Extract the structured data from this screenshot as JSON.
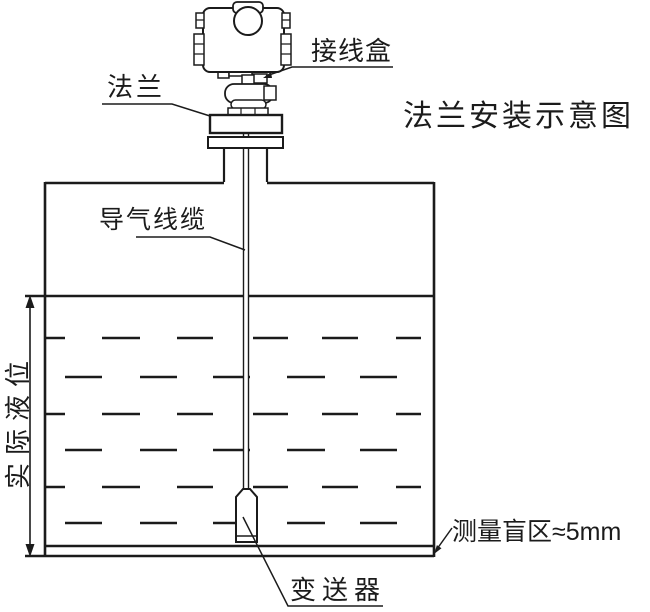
{
  "title": "法兰安装示意图",
  "labels": {
    "junction_box": "接线盒",
    "flange": "法兰",
    "air_cable": "导气线缆",
    "actual_level": "实际液位",
    "blind_zone": "测量盲区≈5mm",
    "transmitter": "变送器"
  },
  "colors": {
    "line": "#1b1b1b",
    "background": "#ffffff"
  }
}
